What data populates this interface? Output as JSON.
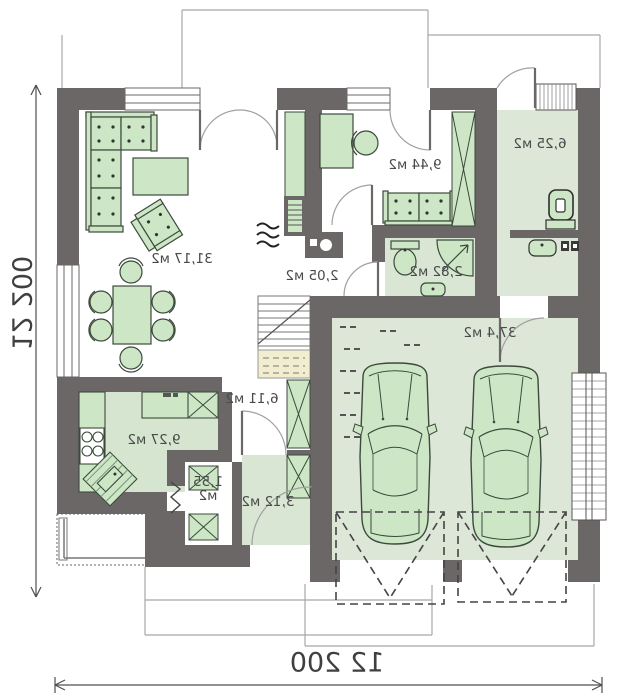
{
  "plan": {
    "type": "floor-plan-mirrored",
    "dimensions": {
      "bottom": "12 200",
      "left": "12 200"
    },
    "rooms": {
      "living": {
        "area": "31,17 м2"
      },
      "office": {
        "area": "9,44 м2"
      },
      "entry_hall": {
        "area": "6,25 м2"
      },
      "fireplace_nook": {
        "area": "2,05 м2"
      },
      "bathroom": {
        "area": "2,82 м2"
      },
      "garage": {
        "area": "37,4 м2"
      },
      "kitchen": {
        "area": "9,27 м2"
      },
      "hall": {
        "area": "6,11 м2"
      },
      "pantry": {
        "area_line1": "1,55",
        "area_line2": "м2"
      },
      "vestibule": {
        "area": "3,12 м2"
      }
    },
    "colors": {
      "wall": "#6b6767",
      "furniture_green": "#cde7c6",
      "floor_green": "#dce7d8",
      "stair_landing_beige": "#f2edcf",
      "line_thin": "#a0a0a0",
      "text": "#4a4a4a"
    }
  }
}
